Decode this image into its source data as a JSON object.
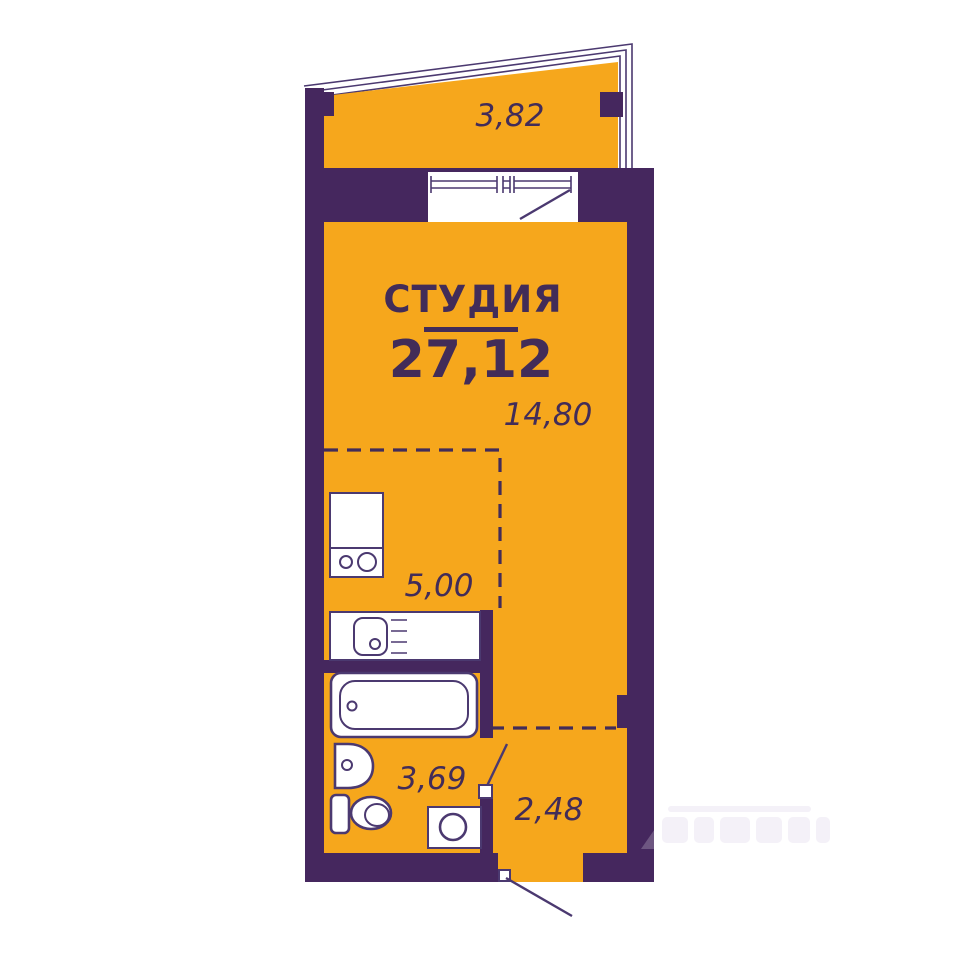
{
  "colors": {
    "room_fill": "#F6A71C",
    "wall_fill": "#45275E",
    "line_color": "#4B3970",
    "text_color": "#422C58",
    "background": "#FFFFFF"
  },
  "floor_plan": {
    "title": "СТУДИЯ",
    "total_area": "27,12",
    "areas": {
      "balcony": "3,82",
      "living_zone": "14,80",
      "kitchen_zone": "5,00",
      "bathroom": "3,69",
      "hallway": "2,48"
    },
    "fixture_icons": [
      "kitchen-counter-icon",
      "stove-icon",
      "kitchen-sink-icon",
      "bathtub-icon",
      "washbasin-icon",
      "toilet-icon",
      "washing-machine-icon"
    ],
    "door_icons": [
      "balcony-door-swing-icon",
      "bathroom-door-swing-icon",
      "entry-door-swing-icon"
    ]
  }
}
